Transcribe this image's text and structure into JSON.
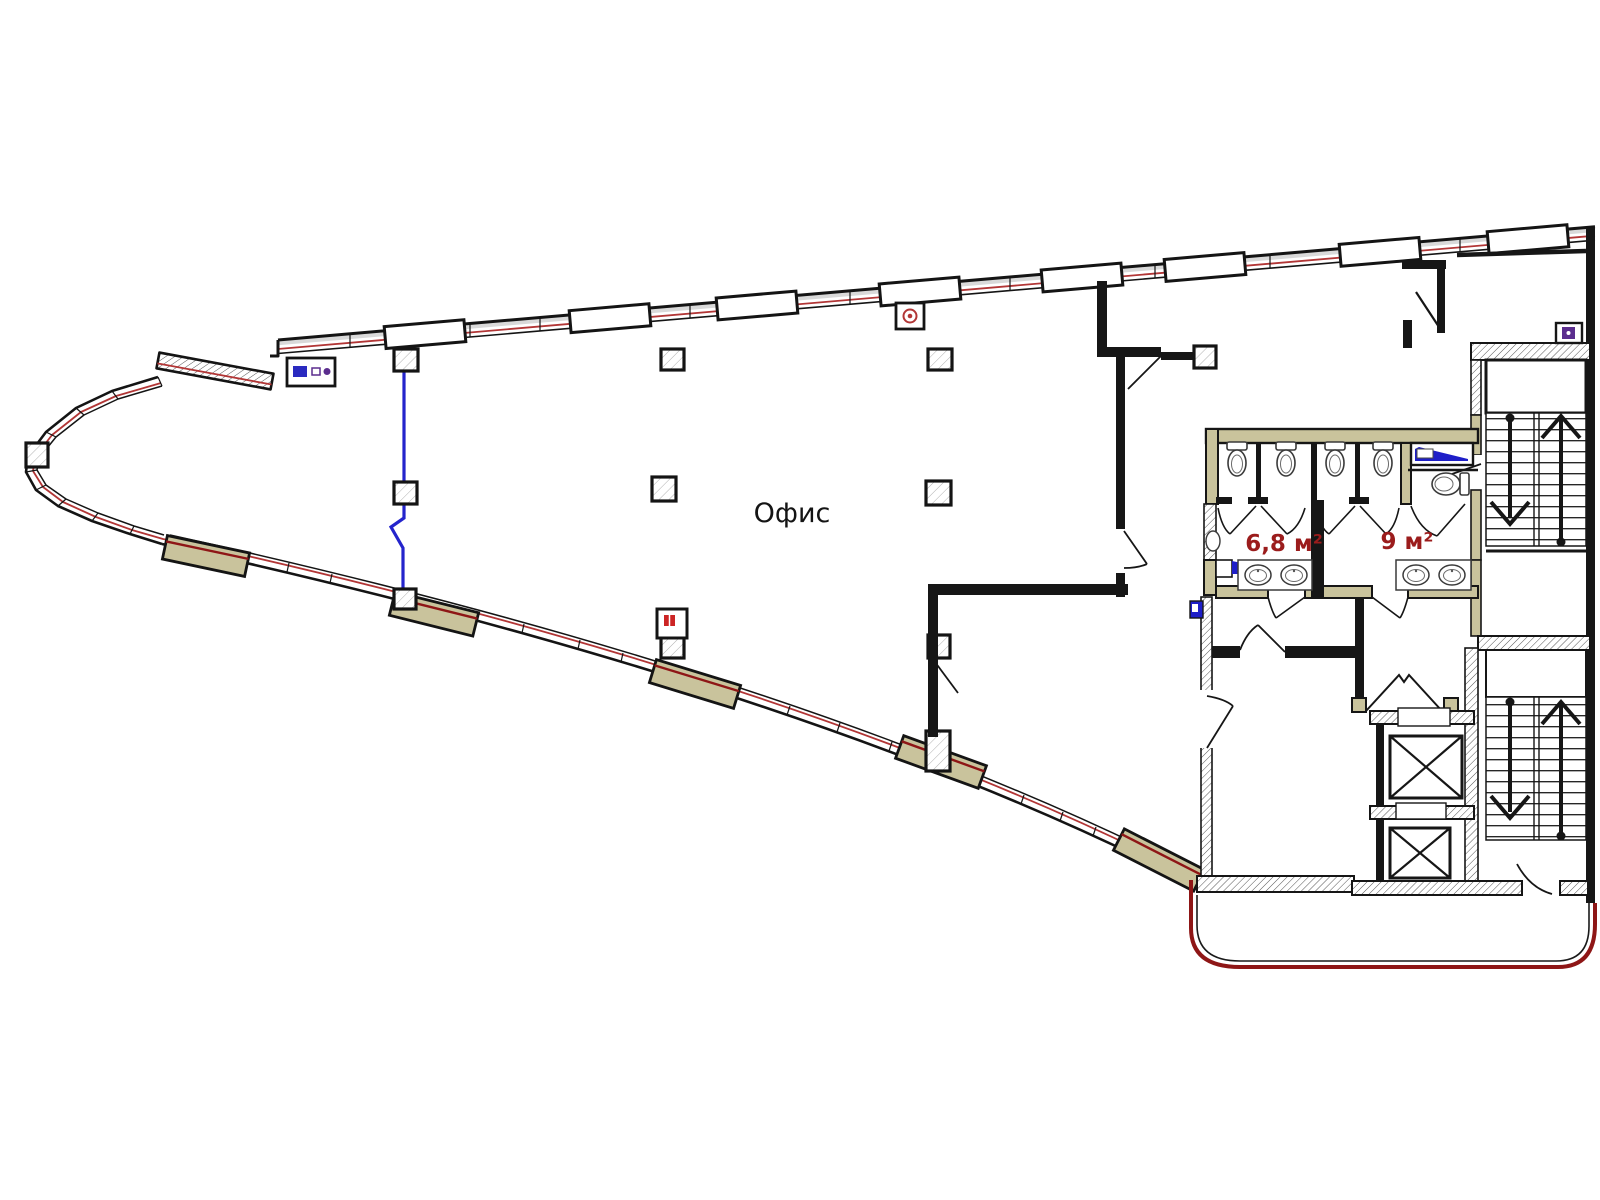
{
  "plan": {
    "type": "architectural-floor-plan",
    "labels": {
      "office": "Офис",
      "room_68": "6,8 м²",
      "room_9": "9 м²"
    },
    "colors": {
      "paper": "#ffffff",
      "wall_black": "#161616",
      "facade_accent_red": "#b23636",
      "apron_deep_red": "#8e1616",
      "room_label_red": "#9b1c1c",
      "wall_tan": "#c9c39c",
      "fixture_blue": "#1e1ec8",
      "riser_blue": "#2424cc",
      "symbol_purple": "#5b2d8e",
      "hatch_gray": "#666666"
    },
    "icons": [
      "column-icon",
      "toilet-icon",
      "sink-icon",
      "urinal-icon",
      "trough-urinal-icon",
      "stair-up-arrow-icon",
      "stair-down-arrow-icon",
      "elevator-icon",
      "door-swing-icon",
      "fire-hydrant-icon",
      "electrical-panel-icon",
      "signal-box-icon",
      "utility-box-icon"
    ]
  }
}
